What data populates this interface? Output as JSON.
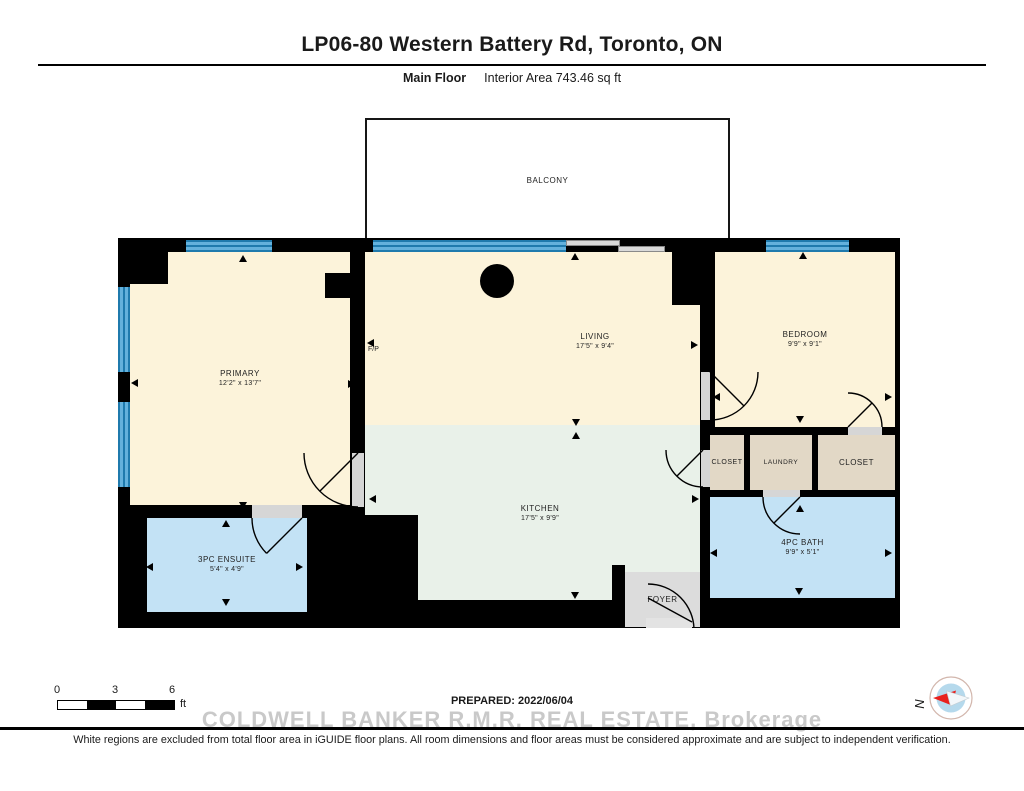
{
  "header": {
    "title": "LP06-80 Western Battery Rd, Toronto, ON",
    "floor_label": "Main Floor",
    "area_label": "Interior Area 743.46 sq ft"
  },
  "rooms": {
    "balcony": {
      "name": "BALCONY"
    },
    "primary": {
      "name": "PRIMARY",
      "dims": "12'2\" x 13'7\""
    },
    "living": {
      "name": "LIVING",
      "dims": "17'5\" x 9'4\""
    },
    "kitchen": {
      "name": "KITCHEN",
      "dims": "17'5\" x 9'9\""
    },
    "bedroom": {
      "name": "BEDROOM",
      "dims": "9'9\" x 9'1\""
    },
    "closet_left": {
      "name": "CLOSET"
    },
    "laundry": {
      "name": "LAUNDRY"
    },
    "closet_right": {
      "name": "CLOSET"
    },
    "bath": {
      "name": "4PC BATH",
      "dims": "9'9\" x 5'1\""
    },
    "ensuite": {
      "name": "3PC ENSUITE",
      "dims": "5'4\" x 4'9\""
    },
    "foyer": {
      "name": "FOYER"
    },
    "fireplace": {
      "name": "F/P"
    }
  },
  "scale_bar": {
    "ticks": [
      "0",
      "3",
      "6"
    ],
    "unit": "ft"
  },
  "compass": {
    "label": "N",
    "needle_color": "#e8211d"
  },
  "footer": {
    "prepared": "PREPARED: 2022/06/04",
    "watermark": "COLDWELL BANKER R.M.R. REAL ESTATE, Brokerage",
    "disclaimer": "White regions are excluded from total floor area in iGUIDE floor plans. All room dimensions and floor areas must be considered approximate and are subject to independent verification."
  },
  "colors": {
    "walls": "#000000",
    "room_cream": "#fcf3da",
    "kitchen_green": "#e9f1e9",
    "bath_blue": "#c3e2f5",
    "closet_tan": "#e2d8c6",
    "foyer_gray": "#dcdcdc",
    "window_blue": "#5aabd8",
    "watermark_gray": "#c9c9c9"
  },
  "arrows": [
    {
      "x": 125,
      "y": 21,
      "d": "u"
    },
    {
      "x": 125,
      "y": 268,
      "d": "d"
    },
    {
      "x": 17,
      "y": 145,
      "d": "l"
    },
    {
      "x": 234,
      "y": 146,
      "d": "r"
    },
    {
      "x": 457,
      "y": 19,
      "d": "u"
    },
    {
      "x": 253,
      "y": 105,
      "d": "l"
    },
    {
      "x": 577,
      "y": 107,
      "d": "r"
    },
    {
      "x": 458,
      "y": 185,
      "d": "d"
    },
    {
      "x": 458,
      "y": 198,
      "d": "u"
    },
    {
      "x": 457,
      "y": 358,
      "d": "d"
    },
    {
      "x": 255,
      "y": 261,
      "d": "l"
    },
    {
      "x": 578,
      "y": 261,
      "d": "r"
    },
    {
      "x": 685,
      "y": 18,
      "d": "u"
    },
    {
      "x": 682,
      "y": 182,
      "d": "d"
    },
    {
      "x": 599,
      "y": 159,
      "d": "l"
    },
    {
      "x": 771,
      "y": 159,
      "d": "r"
    },
    {
      "x": 682,
      "y": 271,
      "d": "u"
    },
    {
      "x": 681,
      "y": 354,
      "d": "d"
    },
    {
      "x": 596,
      "y": 315,
      "d": "l"
    },
    {
      "x": 771,
      "y": 315,
      "d": "r"
    },
    {
      "x": 32,
      "y": 329,
      "d": "l"
    },
    {
      "x": 182,
      "y": 329,
      "d": "r"
    },
    {
      "x": 108,
      "y": 286,
      "d": "u"
    },
    {
      "x": 108,
      "y": 365,
      "d": "d"
    }
  ]
}
